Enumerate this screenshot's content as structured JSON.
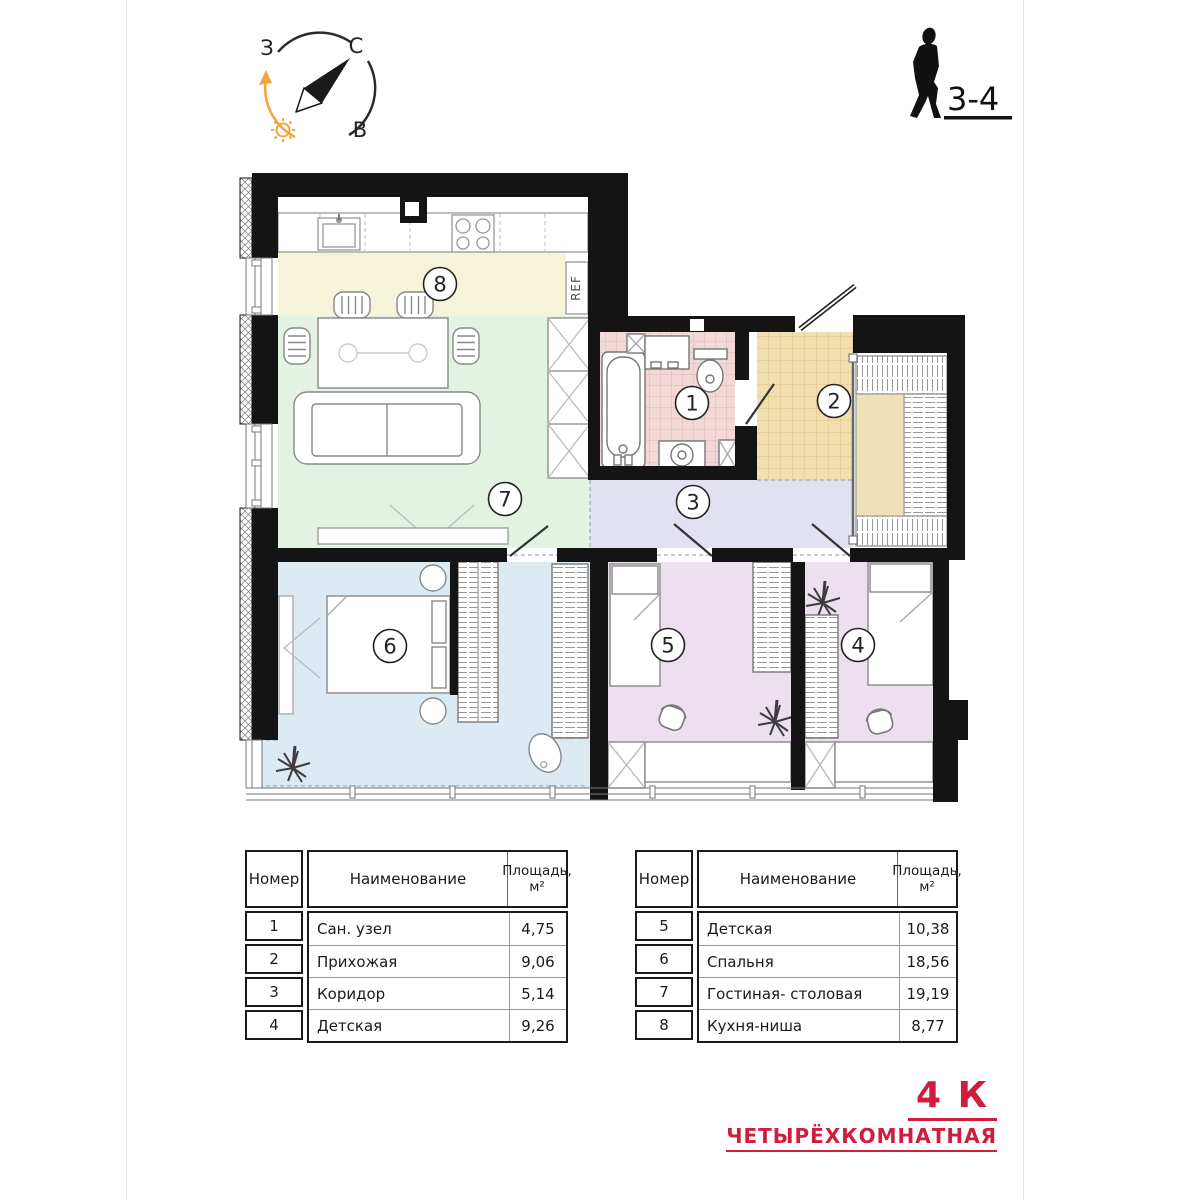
{
  "compass": {
    "west": "З",
    "north": "С",
    "east": "В"
  },
  "floor_badge": {
    "floors": "3-4"
  },
  "plan": {
    "ref_label": "REF",
    "rooms": [
      {
        "number": "1",
        "name": "Сан. узел",
        "area": "4,75",
        "color": "#f3d8d8"
      },
      {
        "number": "2",
        "name": "Прихожая",
        "area": "9,06",
        "color": "#f1dfb0"
      },
      {
        "number": "3",
        "name": "Коридор",
        "area": "5,14",
        "color": "#e2e1f1"
      },
      {
        "number": "4",
        "name": "Детская",
        "area": "9,26",
        "color": "#ecdfee"
      },
      {
        "number": "5",
        "name": "Детская",
        "area": "10,38",
        "color": "#ecdfee"
      },
      {
        "number": "6",
        "name": "Спальня",
        "area": "18,56",
        "color": "#dcebf3"
      },
      {
        "number": "7",
        "name": "Гостиная- столовая",
        "area": "19,19",
        "color": "#e4f2e3"
      },
      {
        "number": "8",
        "name": "Кухня-ниша",
        "area": "8,77",
        "color": "#f5f3da"
      }
    ]
  },
  "table_headers": {
    "number": "Номер",
    "name": "Наименование",
    "area_line1": "Площадь,",
    "area_line2": "м²"
  },
  "title": {
    "code": "4 К",
    "name": "ЧЕТЫРЁХКОМНАТНАЯ",
    "color": "#d01c3e"
  }
}
